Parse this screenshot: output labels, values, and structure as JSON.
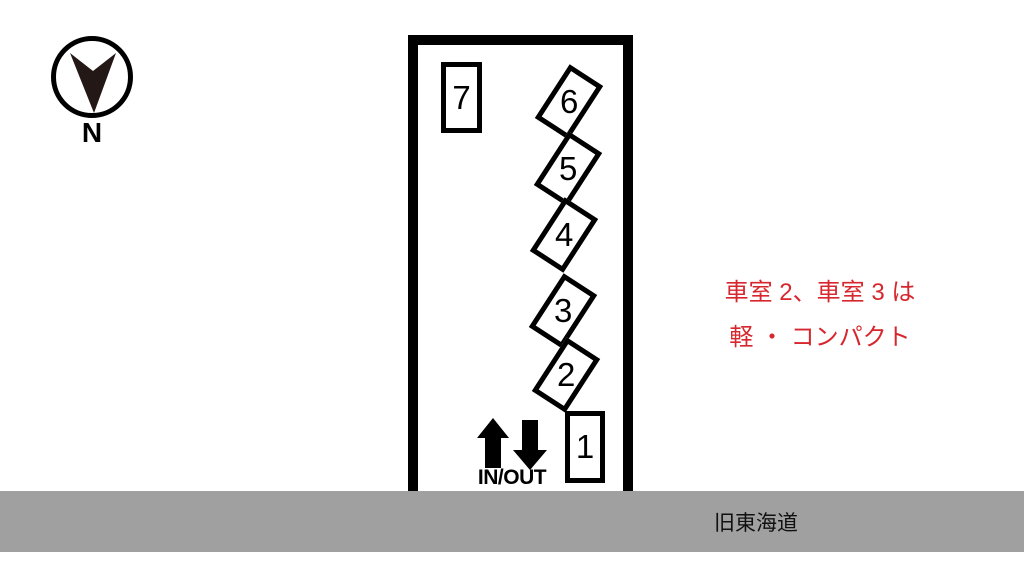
{
  "compass": {
    "north_label": "N",
    "arrow_color": "#231815",
    "arrow_direction": "south-pointing"
  },
  "lot": {
    "spaces": [
      {
        "label": "7",
        "orientation": "upright"
      },
      {
        "label": "6",
        "orientation": "angled"
      },
      {
        "label": "5",
        "orientation": "angled"
      },
      {
        "label": "4",
        "orientation": "angled"
      },
      {
        "label": "3",
        "orientation": "angled"
      },
      {
        "label": "2",
        "orientation": "angled"
      },
      {
        "label": "1",
        "orientation": "upright"
      }
    ],
    "inout_label": "IN/OUT",
    "outline_color": "#000000"
  },
  "note": {
    "line1": "車室 2、車室 3 は",
    "line2": "軽 ・ コンパクト",
    "text_color": "#d7272e"
  },
  "road": {
    "label": "旧東海道",
    "bar_color": "#a0a0a0"
  },
  "icons": {
    "compass_arrow": "compass-south-arrow-icon",
    "in_arrow": "up-arrow-icon",
    "out_arrow": "down-arrow-icon"
  }
}
